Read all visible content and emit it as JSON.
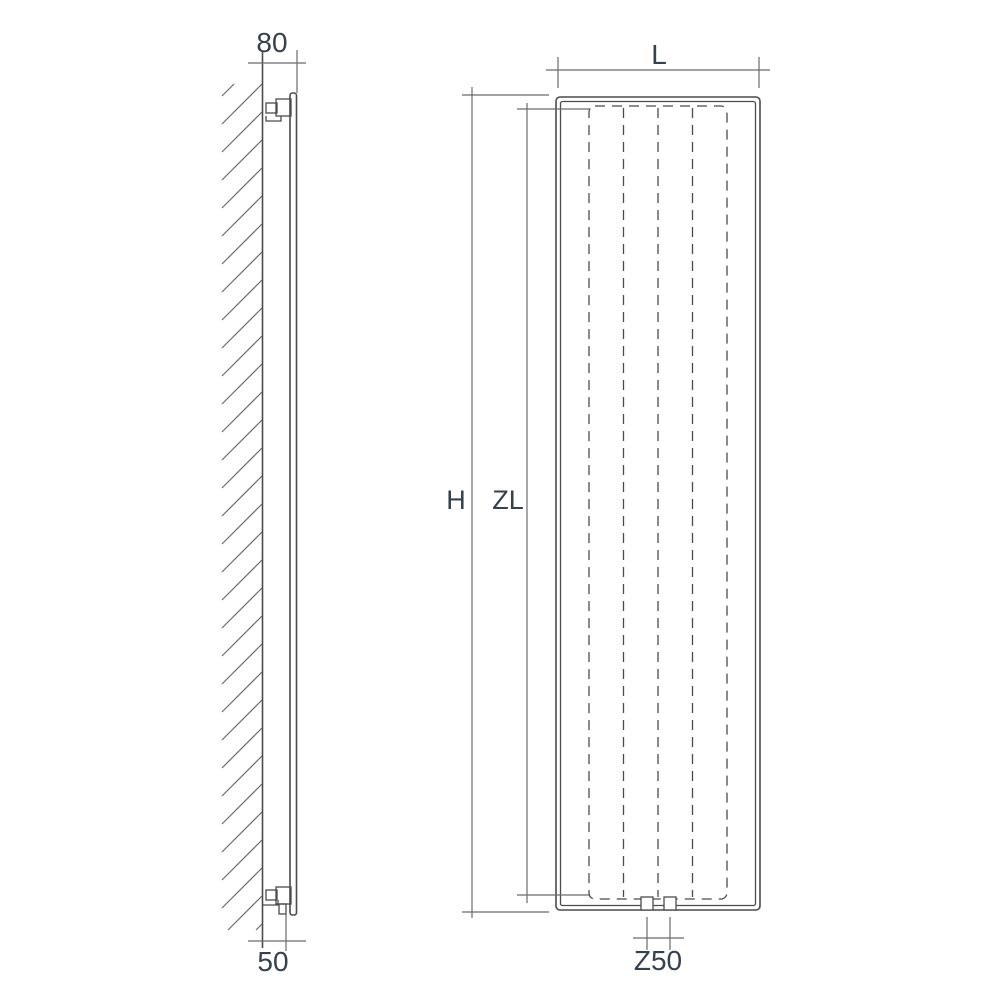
{
  "diagram": {
    "type": "radiator-technical-dimension-drawing",
    "side_view": {
      "depth_dimension": "80",
      "pipe_offset_dimension": "50"
    },
    "front_view": {
      "width_dimension": "L",
      "height_dimension": "H",
      "fin_pack_height_dimension": "ZL",
      "connection_spacing_dimension": "Z50"
    },
    "colors": {
      "line": "#4b4b4b",
      "dimension_line": "#6b6b6b",
      "label": "#37404d",
      "background": "#ffffff"
    }
  }
}
